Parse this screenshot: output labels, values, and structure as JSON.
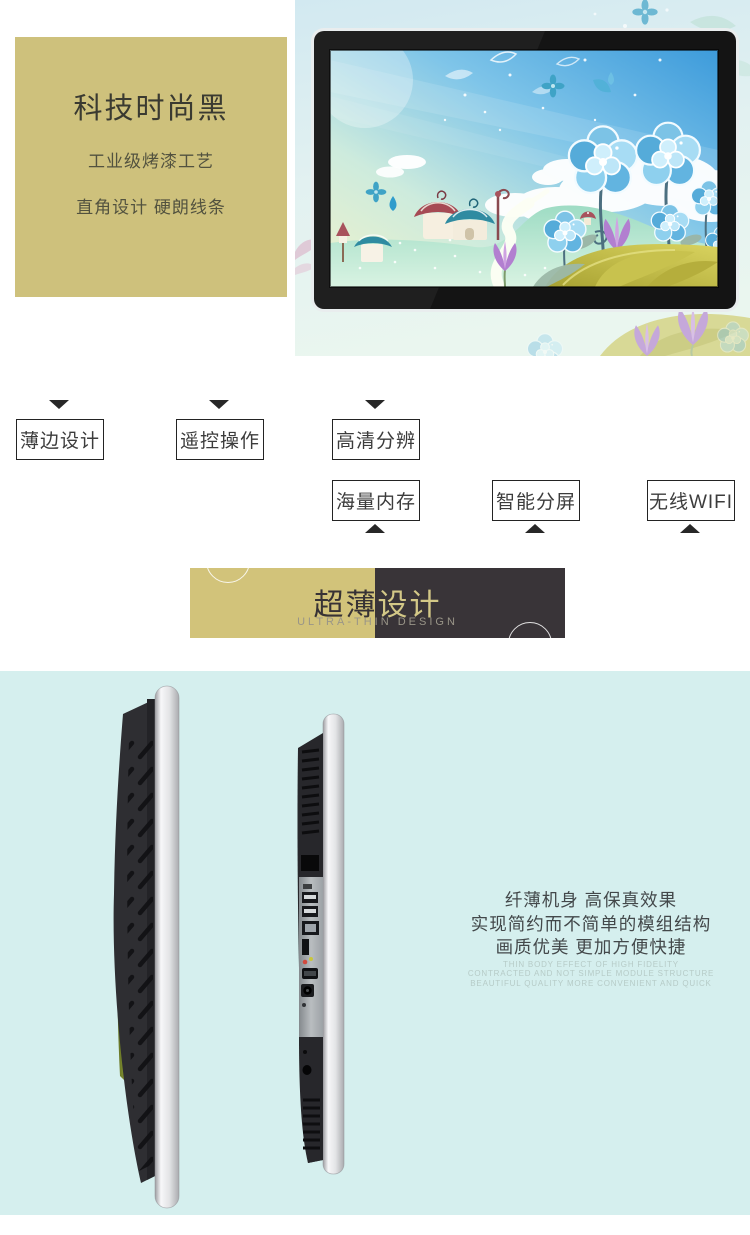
{
  "hero": {
    "title": "科技时尚黑",
    "subtitle1": "工业级烤漆工艺",
    "subtitle2": "直角设计 硬朗线条"
  },
  "features": {
    "row1": [
      {
        "label": "薄边设计"
      },
      {
        "label": "遥控操作"
      },
      {
        "label": "高清分辨"
      }
    ],
    "row2": [
      {
        "label": "海量内存"
      },
      {
        "label": "智能分屏"
      },
      {
        "label": "无线WIFI"
      }
    ]
  },
  "banner": {
    "title_part1": "超薄",
    "title_part2": "设计",
    "subtitle": "ULTRA-THIN DESIGN"
  },
  "thin_section": {
    "cn_lines": [
      "纤薄机身 高保真效果",
      "实现简约而不简单的模组结构",
      "画质优美 更加方便快捷"
    ],
    "en_lines": [
      "THIN BODY EFFECT OF HIGH FIDELITY",
      "CONTRACTED AND NOT SIMPLE MODULE STRUCTURE",
      "BEAUTIFUL QUALITY MORE CONVENIENT AND QUICK"
    ]
  },
  "colors": {
    "khaki_panel": "#cec17c",
    "banner_gold": "#d2c37a",
    "banner_dark": "#393438",
    "section_cyan": "#d5efee",
    "dark_text": "#3a3a31"
  }
}
